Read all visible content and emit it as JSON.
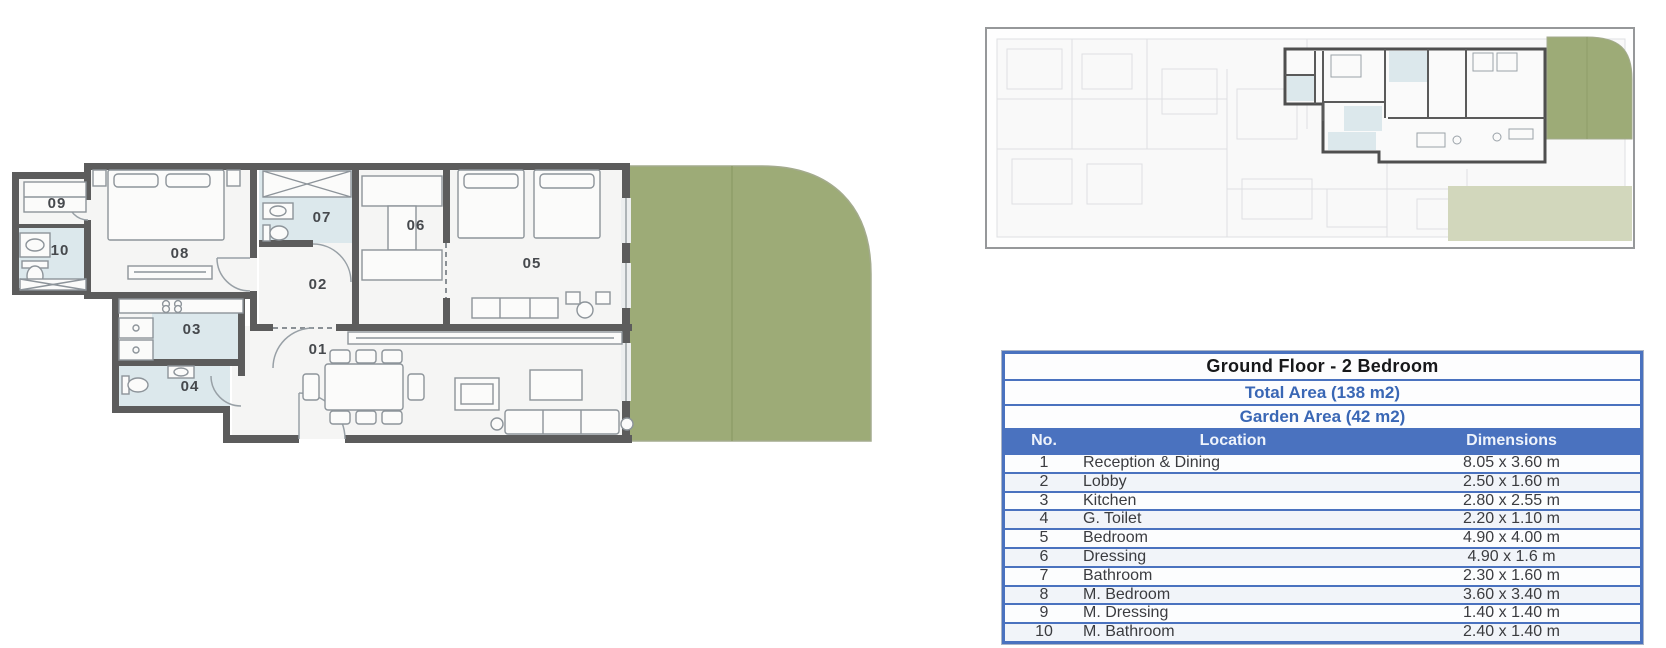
{
  "plan": {
    "rooms": [
      {
        "label": "01"
      },
      {
        "label": "02"
      },
      {
        "label": "03"
      },
      {
        "label": "04"
      },
      {
        "label": "05"
      },
      {
        "label": "06"
      },
      {
        "label": "07"
      },
      {
        "label": "08"
      },
      {
        "label": "09"
      },
      {
        "label": "10"
      }
    ]
  },
  "info_table": {
    "title": "Ground Floor - 2 Bedroom",
    "total_area": "Total Area (138 m2)",
    "garden_area": "Garden Area (42 m2)",
    "columns": {
      "no": "No.",
      "location": "Location",
      "dimensions": "Dimensions"
    },
    "rows": [
      {
        "no": "1",
        "location": "Reception & Dining",
        "dimensions": "8.05 x 3.60 m"
      },
      {
        "no": "2",
        "location": "Lobby",
        "dimensions": "2.50 x 1.60 m"
      },
      {
        "no": "3",
        "location": "Kitchen",
        "dimensions": "2.80 x 2.55 m"
      },
      {
        "no": "4",
        "location": "G. Toilet",
        "dimensions": "2.20 x 1.10 m"
      },
      {
        "no": "5",
        "location": "Bedroom",
        "dimensions": "4.90 x 4.00 m"
      },
      {
        "no": "6",
        "location": "Dressing",
        "dimensions": "4.90 x 1.6 m"
      },
      {
        "no": "7",
        "location": "Bathroom",
        "dimensions": "2.30 x 1.60 m"
      },
      {
        "no": "8",
        "location": "M. Bedroom",
        "dimensions": "3.60 x 3.40 m"
      },
      {
        "no": "9",
        "location": "M. Dressing",
        "dimensions": "1.40 x 1.40 m"
      },
      {
        "no": "10",
        "location": "M. Bathroom",
        "dimensions": "2.40 x 1.40 m"
      }
    ]
  },
  "colors": {
    "garden_green": "#9dab77",
    "garden_pale": "#d2d7bc",
    "wet_room_blue": "#dce8ec",
    "wall_gray": "#5c5c5c",
    "table_border_blue": "#4a72bf",
    "accent_text_blue": "#3a67b5"
  }
}
